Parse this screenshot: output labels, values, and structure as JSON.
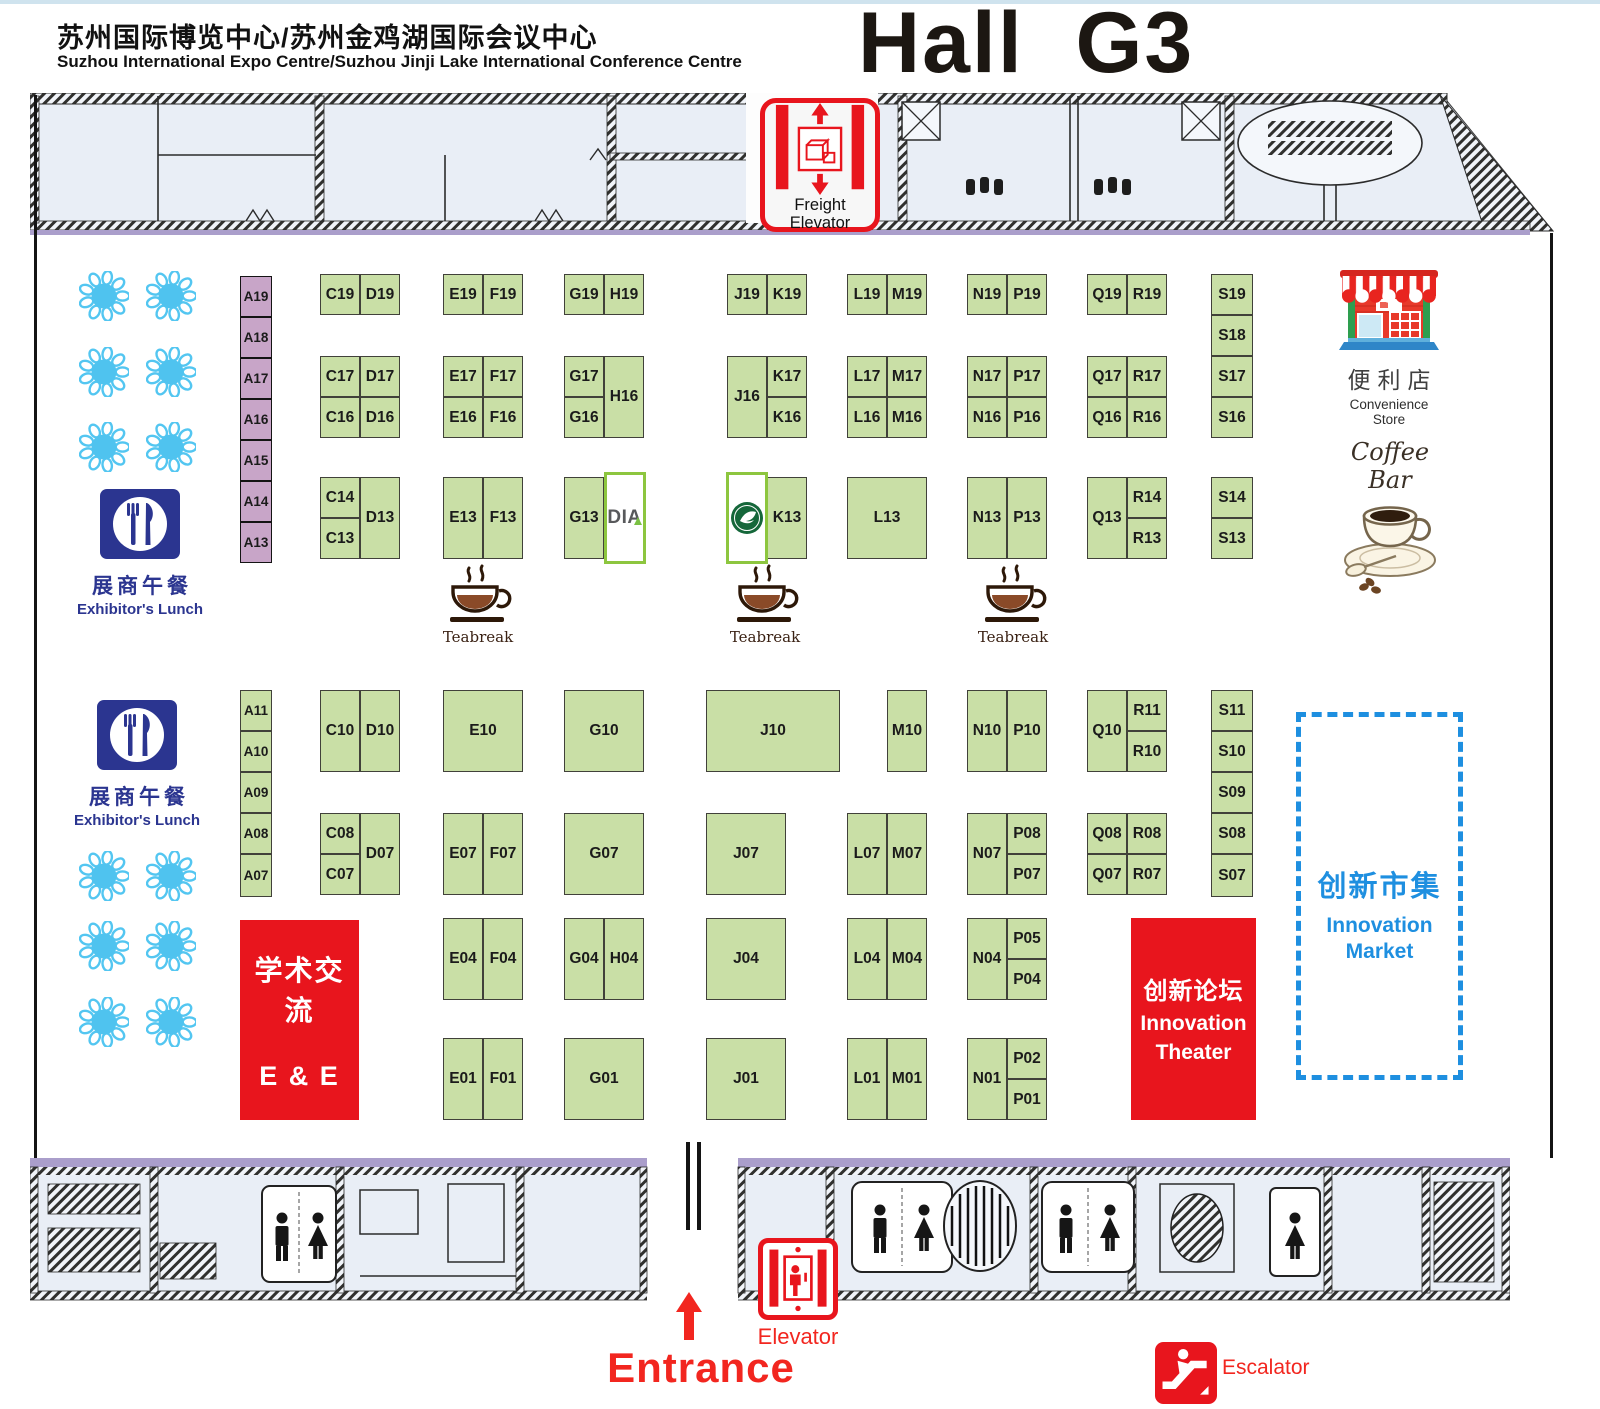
{
  "header": {
    "venue_zh": "苏州国际博览中心/苏州金鸡湖国际会议中心",
    "venue_en": "Suzhou International Expo Centre/Suzhou Jinji Lake International Conference Centre",
    "hall_title": "Hall  G3"
  },
  "colors": {
    "booth_green": "#c9dfa6",
    "booth_purple": "#c8a5c8",
    "special_border_green": "#8dc63f",
    "accent_red": "#e8151d",
    "market_blue": "#1e8fe0",
    "lunch_navy": "#2b3590",
    "table_blue": "#4fc3ef",
    "wall_purple": "#aa9ecb"
  },
  "booths": [
    [
      "A19",
      240,
      276,
      32,
      41,
      "p"
    ],
    [
      "A18",
      240,
      317,
      32,
      41,
      "p"
    ],
    [
      "A17",
      240,
      358,
      32,
      41,
      "p"
    ],
    [
      "A16",
      240,
      399,
      32,
      41,
      "p"
    ],
    [
      "A15",
      240,
      440,
      32,
      41,
      "p"
    ],
    [
      "A14",
      240,
      481,
      32,
      41,
      "p"
    ],
    [
      "A13",
      240,
      522,
      32,
      41,
      "p"
    ],
    [
      "C19",
      320,
      274,
      40,
      41
    ],
    [
      "D19",
      360,
      274,
      40,
      41
    ],
    [
      "E19",
      443,
      274,
      40,
      41
    ],
    [
      "F19",
      483,
      274,
      40,
      41
    ],
    [
      "G19",
      564,
      274,
      40,
      41
    ],
    [
      "H19",
      604,
      274,
      40,
      41
    ],
    [
      "J19",
      727,
      274,
      40,
      41
    ],
    [
      "K19",
      767,
      274,
      40,
      41
    ],
    [
      "L19",
      847,
      274,
      40,
      41
    ],
    [
      "M19",
      887,
      274,
      40,
      41
    ],
    [
      "N19",
      967,
      274,
      40,
      41
    ],
    [
      "P19",
      1007,
      274,
      40,
      41
    ],
    [
      "Q19",
      1087,
      274,
      40,
      41
    ],
    [
      "R19",
      1127,
      274,
      40,
      41
    ],
    [
      "S19",
      1211,
      274,
      42,
      41
    ],
    [
      "S18",
      1211,
      315,
      42,
      41
    ],
    [
      "C17",
      320,
      356,
      40,
      41
    ],
    [
      "D17",
      360,
      356,
      40,
      41
    ],
    [
      "C16",
      320,
      397,
      40,
      41
    ],
    [
      "D16",
      360,
      397,
      40,
      41
    ],
    [
      "E17",
      443,
      356,
      40,
      41
    ],
    [
      "F17",
      483,
      356,
      40,
      41
    ],
    [
      "E16",
      443,
      397,
      40,
      41
    ],
    [
      "F16",
      483,
      397,
      40,
      41
    ],
    [
      "G17",
      564,
      356,
      40,
      41
    ],
    [
      "G16",
      564,
      397,
      40,
      41
    ],
    [
      "H16",
      604,
      356,
      40,
      82
    ],
    [
      "J16",
      727,
      356,
      40,
      82
    ],
    [
      "K17",
      767,
      356,
      40,
      41
    ],
    [
      "K16",
      767,
      397,
      40,
      41
    ],
    [
      "L17",
      847,
      356,
      40,
      41
    ],
    [
      "M17",
      887,
      356,
      40,
      41
    ],
    [
      "L16",
      847,
      397,
      40,
      41
    ],
    [
      "M16",
      887,
      397,
      40,
      41
    ],
    [
      "N17",
      967,
      356,
      40,
      41
    ],
    [
      "P17",
      1007,
      356,
      40,
      41
    ],
    [
      "N16",
      967,
      397,
      40,
      41
    ],
    [
      "P16",
      1007,
      397,
      40,
      41
    ],
    [
      "Q17",
      1087,
      356,
      40,
      41
    ],
    [
      "R17",
      1127,
      356,
      40,
      41
    ],
    [
      "Q16",
      1087,
      397,
      40,
      41
    ],
    [
      "R16",
      1127,
      397,
      40,
      41
    ],
    [
      "S17",
      1211,
      356,
      42,
      41
    ],
    [
      "S16",
      1211,
      397,
      42,
      41
    ],
    [
      "C14",
      320,
      477,
      40,
      41
    ],
    [
      "C13",
      320,
      518,
      40,
      41
    ],
    [
      "D13",
      360,
      477,
      40,
      82
    ],
    [
      "E13",
      443,
      477,
      40,
      82
    ],
    [
      "F13",
      483,
      477,
      40,
      82
    ],
    [
      "G13",
      564,
      477,
      40,
      82
    ],
    [
      "K13",
      767,
      477,
      40,
      82
    ],
    [
      "L13",
      847,
      477,
      80,
      82
    ],
    [
      "N13",
      967,
      477,
      40,
      82
    ],
    [
      "P13",
      1007,
      477,
      40,
      82
    ],
    [
      "Q13",
      1087,
      477,
      40,
      82
    ],
    [
      "R14",
      1127,
      477,
      40,
      41
    ],
    [
      "R13",
      1127,
      518,
      40,
      41
    ],
    [
      "S14",
      1211,
      477,
      42,
      41
    ],
    [
      "S13",
      1211,
      518,
      42,
      41
    ],
    [
      "A11",
      240,
      690,
      32,
      41
    ],
    [
      "A10",
      240,
      731,
      32,
      41
    ],
    [
      "A09",
      240,
      772,
      32,
      41
    ],
    [
      "A08",
      240,
      813,
      32,
      41
    ],
    [
      "A07",
      240,
      854,
      32,
      43
    ],
    [
      "C10",
      320,
      690,
      40,
      82
    ],
    [
      "D10",
      360,
      690,
      40,
      82
    ],
    [
      "E10",
      443,
      690,
      80,
      82
    ],
    [
      "G10",
      564,
      690,
      80,
      82
    ],
    [
      "J10",
      706,
      690,
      134,
      82
    ],
    [
      "M10",
      887,
      690,
      40,
      82
    ],
    [
      "N10",
      967,
      690,
      40,
      82
    ],
    [
      "P10",
      1007,
      690,
      40,
      82
    ],
    [
      "Q10",
      1087,
      690,
      40,
      82
    ],
    [
      "R11",
      1127,
      690,
      40,
      41
    ],
    [
      "R10",
      1127,
      731,
      40,
      41
    ],
    [
      "S11",
      1211,
      690,
      42,
      41
    ],
    [
      "S10",
      1211,
      731,
      42,
      41
    ],
    [
      "S09",
      1211,
      772,
      42,
      41
    ],
    [
      "C08",
      320,
      813,
      40,
      41
    ],
    [
      "C07",
      320,
      854,
      40,
      41
    ],
    [
      "D07",
      360,
      813,
      40,
      82
    ],
    [
      "E07",
      443,
      813,
      40,
      82
    ],
    [
      "F07",
      483,
      813,
      40,
      82
    ],
    [
      "G07",
      564,
      813,
      80,
      82
    ],
    [
      "J07",
      706,
      813,
      80,
      82
    ],
    [
      "L07",
      847,
      813,
      40,
      82
    ],
    [
      "M07",
      887,
      813,
      40,
      82
    ],
    [
      "N07",
      967,
      813,
      40,
      82
    ],
    [
      "P08",
      1007,
      813,
      40,
      41
    ],
    [
      "P07",
      1007,
      854,
      40,
      41
    ],
    [
      "Q08",
      1087,
      813,
      40,
      41
    ],
    [
      "R08",
      1127,
      813,
      40,
      41
    ],
    [
      "Q07",
      1087,
      854,
      40,
      41
    ],
    [
      "R07",
      1127,
      854,
      40,
      41
    ],
    [
      "S08",
      1211,
      813,
      42,
      41
    ],
    [
      "S07",
      1211,
      854,
      42,
      43
    ],
    [
      "E04",
      443,
      918,
      40,
      82
    ],
    [
      "F04",
      483,
      918,
      40,
      82
    ],
    [
      "G04",
      564,
      918,
      40,
      82
    ],
    [
      "H04",
      604,
      918,
      40,
      82
    ],
    [
      "J04",
      706,
      918,
      80,
      82
    ],
    [
      "L04",
      847,
      918,
      40,
      82
    ],
    [
      "M04",
      887,
      918,
      40,
      82
    ],
    [
      "N04",
      967,
      918,
      40,
      82
    ],
    [
      "P05",
      1007,
      918,
      40,
      41
    ],
    [
      "P04",
      1007,
      959,
      40,
      41
    ],
    [
      "E01",
      443,
      1038,
      40,
      82
    ],
    [
      "F01",
      483,
      1038,
      40,
      82
    ],
    [
      "G01",
      564,
      1038,
      80,
      82
    ],
    [
      "J01",
      706,
      1038,
      80,
      82
    ],
    [
      "L01",
      847,
      1038,
      40,
      82
    ],
    [
      "M01",
      887,
      1038,
      40,
      82
    ],
    [
      "N01",
      967,
      1038,
      40,
      82
    ],
    [
      "P02",
      1007,
      1038,
      40,
      41
    ],
    [
      "P01",
      1007,
      1079,
      40,
      41
    ]
  ],
  "special_booths": [
    {
      "id": "dia-booth",
      "logo": "DIA",
      "x": 604,
      "y": 472,
      "w": 42,
      "h": 92
    },
    {
      "id": "j13-seal-booth",
      "logo": "seal",
      "x": 726,
      "y": 472,
      "w": 42,
      "h": 92
    }
  ],
  "areas": {
    "academic": {
      "zh": "学术交流",
      "en": "E & E"
    },
    "theater": {
      "zh": "创新论坛",
      "en1": "Innovation",
      "en2": "Theater"
    },
    "market": {
      "zh": "创新市集",
      "en": "Innovation Market"
    }
  },
  "facilities": {
    "freight_elevator": {
      "label": "Freight Elevator"
    },
    "elevator": {
      "label": "Elevator"
    },
    "escalator": {
      "label": "Escalator"
    },
    "entrance": {
      "label": "Entrance"
    },
    "convenience_store": {
      "zh": "便利店",
      "en": "Convenience Store"
    },
    "coffee_bar": {
      "label": "Coffee Bar"
    },
    "exhibitors_lunch": {
      "zh": "展商午餐",
      "en": "Exhibitor's Lunch",
      "positions": [
        [
          58,
          489
        ],
        [
          55,
          700
        ]
      ]
    },
    "teabreak": {
      "label": "Teabreak",
      "positions": [
        [
          441,
          563
        ],
        [
          728,
          563
        ],
        [
          976,
          563
        ]
      ]
    }
  },
  "tables": [
    [
      104,
      296
    ],
    [
      171,
      296
    ],
    [
      104,
      372
    ],
    [
      171,
      372
    ],
    [
      104,
      447
    ],
    [
      171,
      447
    ],
    [
      104,
      876
    ],
    [
      171,
      876
    ],
    [
      104,
      946
    ],
    [
      171,
      946
    ],
    [
      104,
      1022
    ],
    [
      171,
      1022
    ]
  ]
}
